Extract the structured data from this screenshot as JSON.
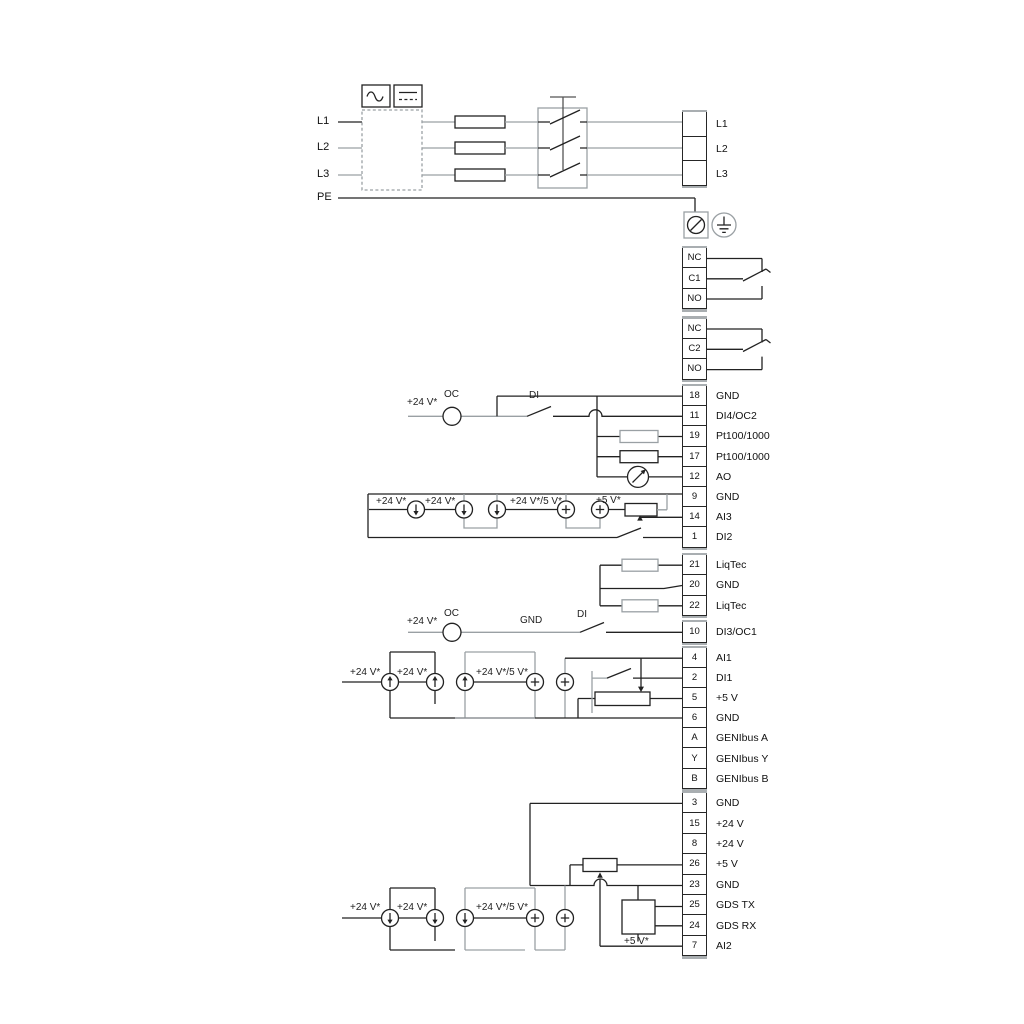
{
  "colors": {
    "wire": "#222222",
    "wire_alt": "#9aa0a4",
    "background": "#ffffff"
  },
  "power_input": {
    "line_labels": [
      "L1",
      "L2",
      "L3",
      "PE"
    ],
    "converter_icons": [
      "ac-sine-icon",
      "dc-line-icon"
    ]
  },
  "terminal_groups": {
    "power_out": [
      {
        "no": "",
        "label": "L1"
      },
      {
        "no": "",
        "label": "L2"
      },
      {
        "no": "",
        "label": "L3"
      }
    ],
    "relay1": [
      "NC",
      "C1",
      "NO"
    ],
    "relay2": [
      "NC",
      "C2",
      "NO"
    ],
    "io_top": [
      {
        "no": "18",
        "label": "GND"
      },
      {
        "no": "11",
        "label": "DI4/OC2"
      },
      {
        "no": "19",
        "label": "Pt100/1000"
      },
      {
        "no": "17",
        "label": "Pt100/1000"
      },
      {
        "no": "12",
        "label": "AO"
      },
      {
        "no": "9",
        "label": "GND"
      },
      {
        "no": "14",
        "label": "AI3"
      },
      {
        "no": "1",
        "label": "DI2"
      }
    ],
    "liqtec": [
      {
        "no": "21",
        "label": "LiqTec"
      },
      {
        "no": "20",
        "label": "GND"
      },
      {
        "no": "22",
        "label": "LiqTec"
      }
    ],
    "di3": [
      {
        "no": "10",
        "label": "DI3/OC1"
      }
    ],
    "io_mid": [
      {
        "no": "4",
        "label": "AI1"
      },
      {
        "no": "2",
        "label": "DI1"
      },
      {
        "no": "5",
        "label": "+5 V"
      },
      {
        "no": "6",
        "label": "GND"
      },
      {
        "no": "A",
        "label": "GENIbus A"
      },
      {
        "no": "Y",
        "label": "GENIbus Y"
      },
      {
        "no": "B",
        "label": "GENIbus B"
      }
    ],
    "io_bottom": [
      {
        "no": "3",
        "label": "GND"
      },
      {
        "no": "15",
        "label": "+24 V"
      },
      {
        "no": "8",
        "label": "+24 V"
      },
      {
        "no": "26",
        "label": "+5 V"
      },
      {
        "no": "23",
        "label": "GND"
      },
      {
        "no": "25",
        "label": "GDS TX"
      },
      {
        "no": "24",
        "label": "GDS RX"
      },
      {
        "no": "7",
        "label": "AI2"
      }
    ]
  },
  "annotations": {
    "t11": {
      "v24": "+24 V*",
      "oc": "OC",
      "di": "DI"
    },
    "ai3_group": {
      "v24_1": "+24 V*",
      "v24_2": "+24 V*",
      "v24_5": "+24 V*/5 V*",
      "v5": "+5 V*"
    },
    "di3_row": {
      "v24": "+24 V*",
      "oc": "OC",
      "gnd": "GND",
      "di": "DI"
    },
    "ai1_group": {
      "v24_1": "+24 V*",
      "v24_2": "+24 V*",
      "v24_5": "+24 V*/5 V*"
    },
    "ai2_group": {
      "v24_1": "+24 V*",
      "v24_2": "+24 V*",
      "v24_5": "+24 V*/5 V*",
      "v5": "+5 V*"
    }
  }
}
